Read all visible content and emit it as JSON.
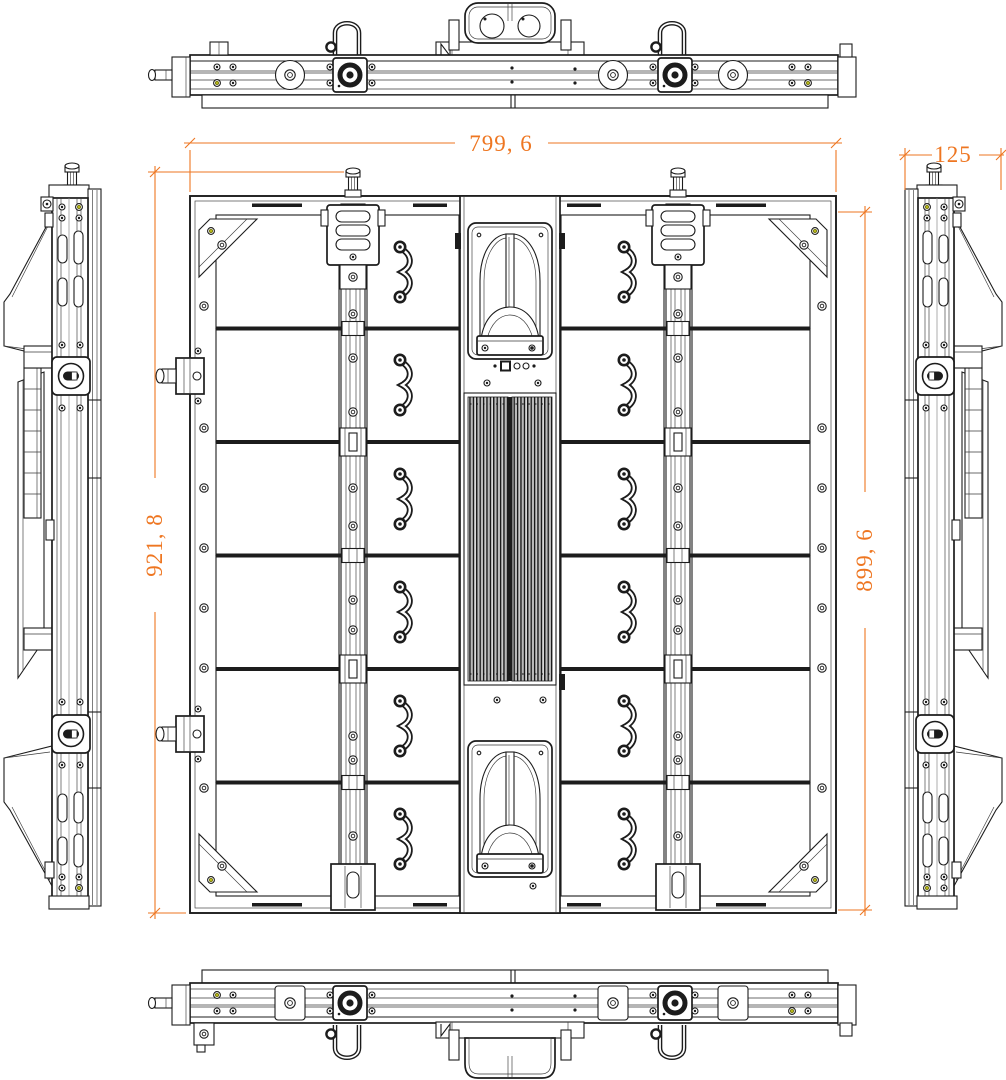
{
  "dimensions": {
    "overall_width": "799, 6",
    "overall_height_left": "921, 8",
    "cabinet_height_right": "899, 6",
    "cabinet_depth": "125"
  },
  "views": {
    "center": "rear-view",
    "top": "top-view",
    "bottom": "bottom-view",
    "left": "left-side-view",
    "right": "right-side-view"
  },
  "structure": {
    "module_rows": 6,
    "module_columns": 4,
    "vertical_rails": 2,
    "lifting_handles_per_column": 6
  },
  "colors": {
    "dimension": "#ee7621",
    "line": "#1c1c1c",
    "screw_accent": "#b9b918",
    "background": "#ffffff"
  }
}
